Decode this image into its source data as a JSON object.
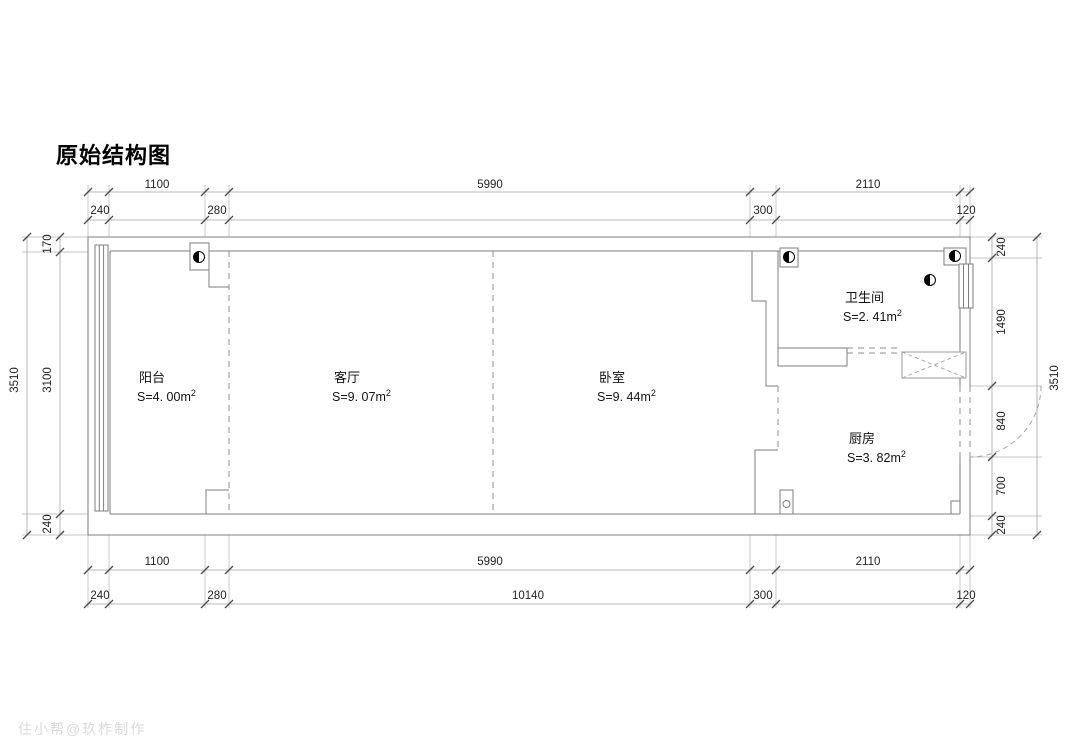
{
  "title": "原始结构图",
  "watermark": "住小帮@玖柞制作",
  "rooms": {
    "balcony": {
      "name": "阳台",
      "area": "S=4. 00m",
      "area_sup": "2"
    },
    "living": {
      "name": "客厅",
      "area": "S=9. 07m",
      "area_sup": "2"
    },
    "bedroom": {
      "name": "卧室",
      "area": "S=9. 44m",
      "area_sup": "2"
    },
    "bathroom": {
      "name": "卫生间",
      "area": "S=2. 41m",
      "area_sup": "2"
    },
    "kitchen": {
      "name": "厨房",
      "area": "S=3. 82m",
      "area_sup": "2"
    }
  },
  "dimensions": {
    "top_main": [
      "1100",
      "5990",
      "2110"
    ],
    "top_sub": [
      "240",
      "280",
      "300",
      "120"
    ],
    "bottom_main": [
      "1100",
      "5990",
      "2110"
    ],
    "bottom_sub": [
      "240",
      "280",
      "10140",
      "300",
      "120"
    ],
    "left_outer": "3510",
    "left_inner": [
      "170",
      "3100",
      "240"
    ],
    "right_inner": [
      "240",
      "1490",
      "840",
      "700",
      "240"
    ],
    "right_outer": "3510"
  }
}
